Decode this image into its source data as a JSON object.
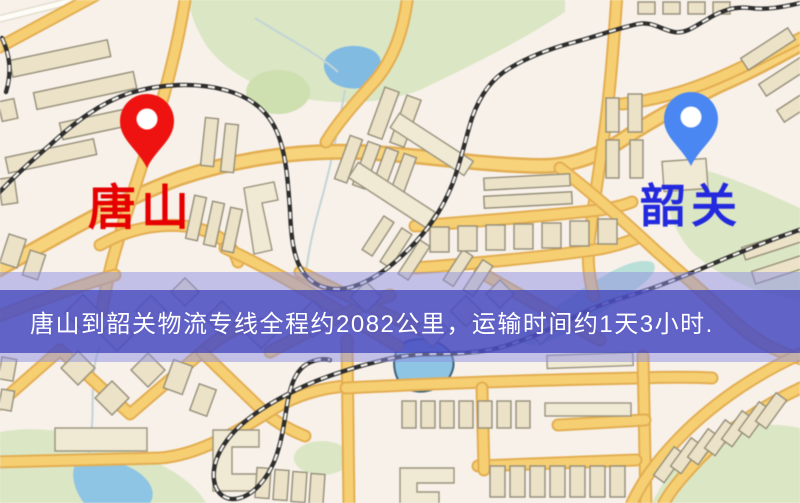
{
  "map": {
    "type": "stylized-road-map",
    "colors": {
      "background": "#f7f1ea",
      "road": "#f6cf72",
      "park": "#dbe6c4",
      "water": "#8ec4e4",
      "building": "#ebe2c8",
      "railway": "#2e2e2e"
    }
  },
  "markers": [
    {
      "id": "tangshan",
      "label": "唐山",
      "pin_color": "#ee1310",
      "label_color": "#e60000"
    },
    {
      "id": "shaoguan",
      "label": "韶关",
      "pin_color": "#4a87f2",
      "label_color": "#2329dc"
    }
  ],
  "banner": {
    "text": "唐山到韶关物流专线全程约2082公里，运输时间约1天3小时.",
    "origin": "唐山",
    "destination": "韶关",
    "distance_km": 2082,
    "duration": "1天3小时",
    "core_color": "#4042bc",
    "tint_color": "#8d90e2",
    "text_color": "#ffffff"
  }
}
